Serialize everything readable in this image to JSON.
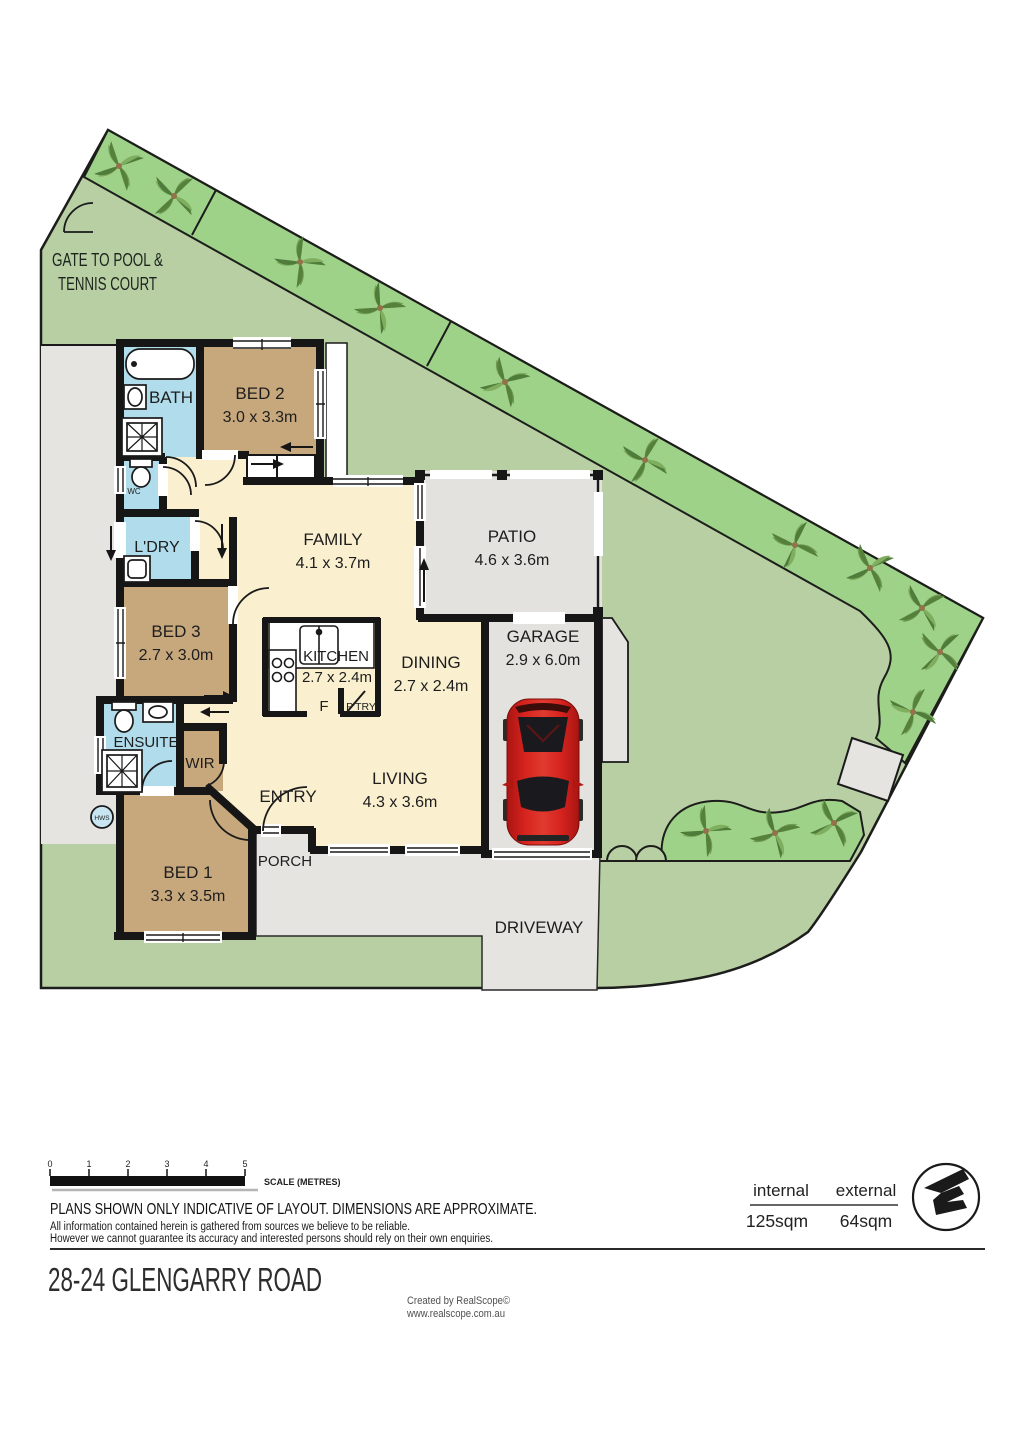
{
  "plan": {
    "gate_note_line1": "GATE TO POOL &",
    "gate_note_line2": "TENNIS COURT",
    "hws_label": "HWS",
    "wc_label": "WC",
    "fridge_label": "F",
    "pantry_label": "P'TRY",
    "rooms": {
      "bath": {
        "name": "BATH"
      },
      "bed2": {
        "name": "BED 2",
        "dims": "3.0 x 3.3m"
      },
      "family": {
        "name": "FAMILY",
        "dims": "4.1 x 3.7m"
      },
      "patio": {
        "name": "PATIO",
        "dims": "4.6 x 3.6m"
      },
      "ldry": {
        "name": "L'DRY"
      },
      "bed3": {
        "name": "BED 3",
        "dims": "2.7 x 3.0m"
      },
      "kitchen": {
        "name": "KITCHEN",
        "dims": "2.7 x 2.4m"
      },
      "dining": {
        "name": "DINING",
        "dims": "2.7 x 2.4m"
      },
      "garage": {
        "name": "GARAGE",
        "dims": "2.9 x 6.0m"
      },
      "ensuite": {
        "name": "ENSUITE"
      },
      "wir": {
        "name": "WIR"
      },
      "entry": {
        "name": "ENTRY"
      },
      "living": {
        "name": "LIVING",
        "dims": "4.3 x 3.6m"
      },
      "bed1": {
        "name": "BED 1",
        "dims": "3.3 x 3.5m"
      },
      "porch": {
        "name": "PORCH"
      },
      "driveway": {
        "name": "DRIVEWAY"
      }
    }
  },
  "scalebar": {
    "ticks": [
      "0",
      "1",
      "2",
      "3",
      "4",
      "5"
    ],
    "caption": "SCALE (METRES)"
  },
  "disclaimer": {
    "headline": "PLANS SHOWN ONLY INDICATIVE OF LAYOUT.  DIMENSIONS ARE APPROXIMATE.",
    "line1": "All information contained herein is gathered from sources we believe to be reliable.",
    "line2": "However we cannot guarantee its accuracy and interested persons should rely on their own enquiries."
  },
  "areas": {
    "internal_label": "internal",
    "internal_value": "125sqm",
    "external_label": "external",
    "external_value": "64sqm"
  },
  "footer": {
    "address": "28-24 GLENGARRY ROAD",
    "credit_line1": "Created by RealScope©",
    "credit_line2": "www.realscope.com.au"
  },
  "colors": {
    "grass": "#b7cfa3",
    "garden_bed": "#9ed289",
    "paving": "#e6e4e0",
    "wall": "#161616",
    "interior": "#faf0cf",
    "bedroom": "#c7a77c",
    "wet_area": "#b0dcec",
    "car": "#d6231f"
  }
}
